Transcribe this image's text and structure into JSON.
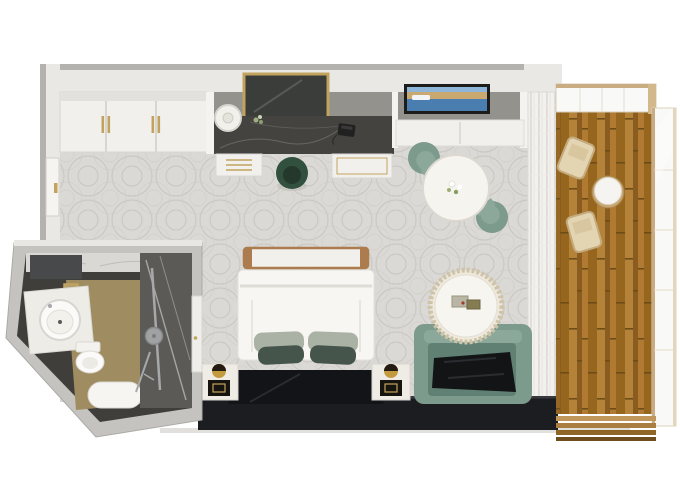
{
  "meta": {
    "type": "3d-floor-plan-render",
    "description": "Top-down 3D rendering of a hotel guest room with en-suite bathroom and private balcony",
    "visible_text": []
  },
  "palette": {
    "background": "#ffffff",
    "wall_outer": "#b3b2ae",
    "wall_top": "#e9e8e4",
    "wall_face": "#93928c",
    "trim": "#d8d6d2",
    "cabinet_white": "#f1f0ec",
    "gold": "#c2a35e",
    "marble_desk": "#45433f",
    "marble_vein": "#868480",
    "carpet_base": "#dbd9d5",
    "carpet_line": "#c5c3be",
    "curtain_base": "#f2f1ed",
    "curtain_fold": "#dedcd5",
    "forest_green": "#31503e",
    "forest_green_dark": "#24382c",
    "sage": "#7c9b8d",
    "sage_light": "#8ba89a",
    "sage_dark": "#5f8073",
    "table_white": "#f6f4ef",
    "wood_trim": "#ad7c4e",
    "duvet": "#f7f6f2",
    "pillow_light": "#a9b2a4",
    "pillow_dark": "#45554b",
    "dark_panel": "#131417",
    "dark_wall": "#1c1d20",
    "nightstand": "#efece6",
    "lamp_gold": "#c49a3f",
    "deck_wood": "#a9752f",
    "deck_wood_dark": "#96661f",
    "deck_wood_light": "#b5823a",
    "rail_tan": "#c9ac82",
    "glass_white": "#f9f9f7",
    "bath_outer": "#c4c3bf",
    "bath_inner": "#403e3a",
    "bath_tan": "#9f8c60",
    "shower_glass": "#5b5a57",
    "marble_white": "#dad8d4",
    "fixture_white": "#fbfaf8",
    "chrome": "#a7a8aa",
    "tv_frame": "#1c1c1a",
    "tv_sky": "#8fb6d9",
    "tv_sand": "#c9a96f",
    "tv_sea": "#4a7eb0",
    "balcony_chair": "#e3d4b2"
  },
  "scene": {
    "rooms": [
      {
        "id": "bedroom",
        "label": "main guest room with bed, vanity desk, dining nook and lounge seating"
      },
      {
        "id": "bathroom",
        "label": "en-suite bathroom with round basin, toilet, tub and rain shower"
      },
      {
        "id": "balcony",
        "label": "private balcony with wood decking, two chairs and a side table"
      }
    ],
    "objects": [
      {
        "id": "wardrobe",
        "label": "white sliding-door wardrobe with gold handles"
      },
      {
        "id": "entry-door",
        "label": "entry door with gold handle"
      },
      {
        "id": "vanity-mirror",
        "label": "gold framed smoked-glass mirror"
      },
      {
        "id": "vanity-desk",
        "label": "dark marble vanity desk"
      },
      {
        "id": "desk-lamp",
        "label": "white drum table lamp"
      },
      {
        "id": "telephone",
        "label": "black telephone"
      },
      {
        "id": "desk-chair",
        "label": "dark green tub chair"
      },
      {
        "id": "drawer-unit",
        "label": "white drawers with gold pulls"
      },
      {
        "id": "tv",
        "label": "wall-mounted TV showing coastal cruise scene"
      },
      {
        "id": "tv-cabinet",
        "label": "white wall cabinet below TV"
      },
      {
        "id": "dining-table",
        "label": "round white dining table with flower posy"
      },
      {
        "id": "dining-chairs",
        "label": "two sage green tub chairs"
      },
      {
        "id": "sheer-curtains",
        "label": "floor-to-ceiling sheer curtains along window wall"
      },
      {
        "id": "bed",
        "label": "double bed, white duvet, sage and dark green pillows"
      },
      {
        "id": "bed-bench",
        "label": "wood-trimmed bench at foot of bed"
      },
      {
        "id": "headboard",
        "label": "glossy black headboard panel"
      },
      {
        "id": "nightstands",
        "label": "two white nightstands with gold sphere lamps"
      },
      {
        "id": "coffee-table",
        "label": "round pleated-base coffee table with books"
      },
      {
        "id": "sofa",
        "label": "sage green loveseat with dark throw"
      },
      {
        "id": "media-wall",
        "label": "dark console wall along window side"
      },
      {
        "id": "washbasin",
        "label": "round white vessel basin on counter"
      },
      {
        "id": "toilet",
        "label": "white toilet"
      },
      {
        "id": "bathtub",
        "label": "compact white tub"
      },
      {
        "id": "rain-shower",
        "label": "chrome rain shower column behind glass"
      },
      {
        "id": "balcony-chairs",
        "label": "two light wood balcony chairs"
      },
      {
        "id": "balcony-table",
        "label": "round drum side table"
      },
      {
        "id": "balcony-railing",
        "label": "glass railing with tan frame"
      }
    ]
  }
}
